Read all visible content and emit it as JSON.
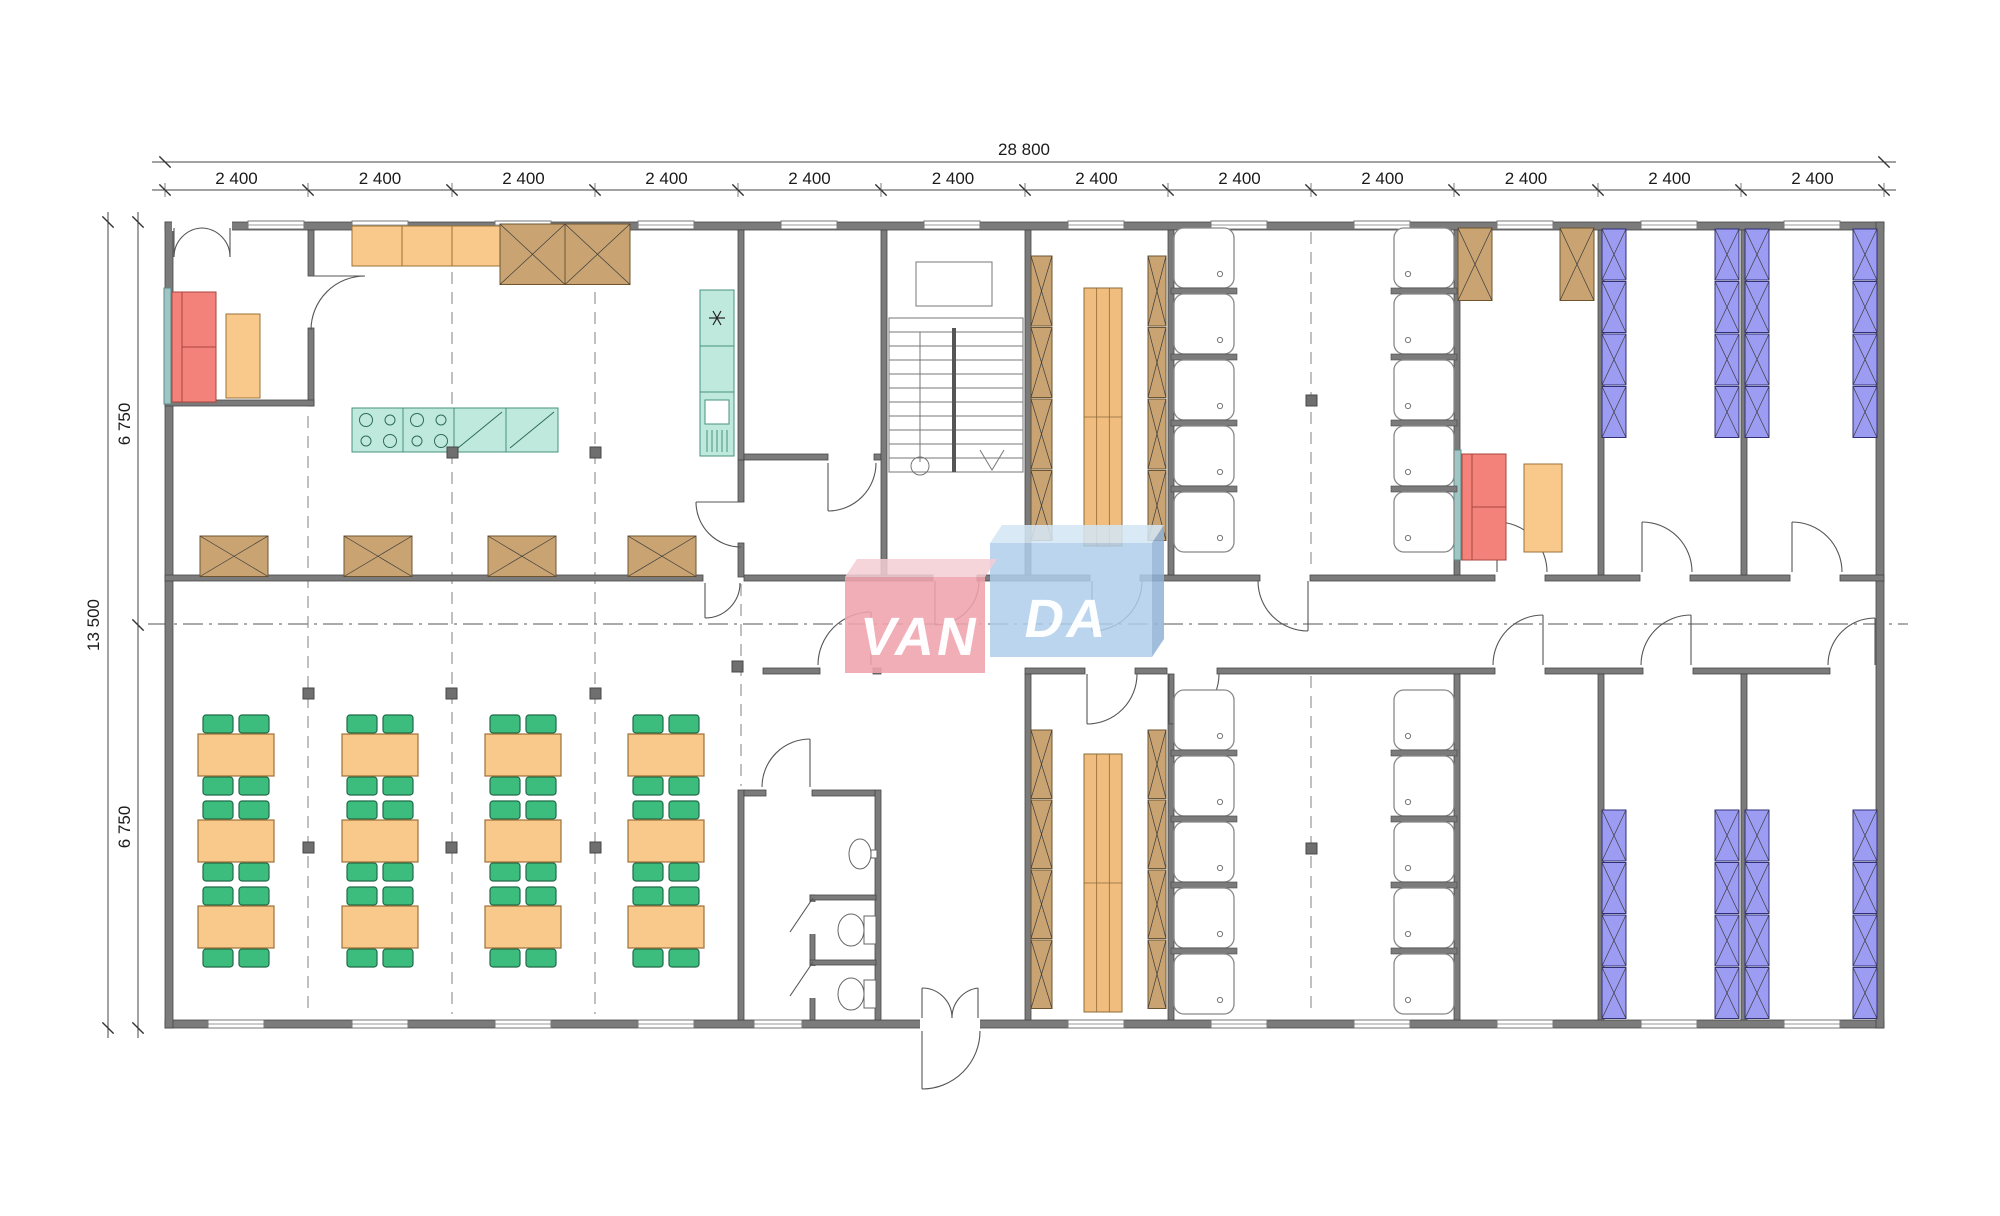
{
  "dimensions": {
    "total_width": "28 800",
    "modules": [
      "2 400",
      "2 400",
      "2 400",
      "2 400",
      "2 400",
      "2 400",
      "2 400",
      "2 400",
      "2 400",
      "2 400",
      "2 400",
      "2 400"
    ],
    "total_height": "13 500",
    "halves": [
      "6 750",
      "6 750"
    ]
  },
  "logo": {
    "left": "VAN",
    "right": "DA",
    "pink": "#efa3ad",
    "blue": "#aeceea"
  },
  "colors": {
    "wall": "#7b7b7b",
    "furniture_orange": "#f8c98a",
    "furniture_green": "#3dbd7d",
    "furniture_red": "#f3837a",
    "furniture_teal": "#bfe9dd",
    "bed_purple": "#9c9cf2",
    "wood_brown": "#c9a472"
  }
}
